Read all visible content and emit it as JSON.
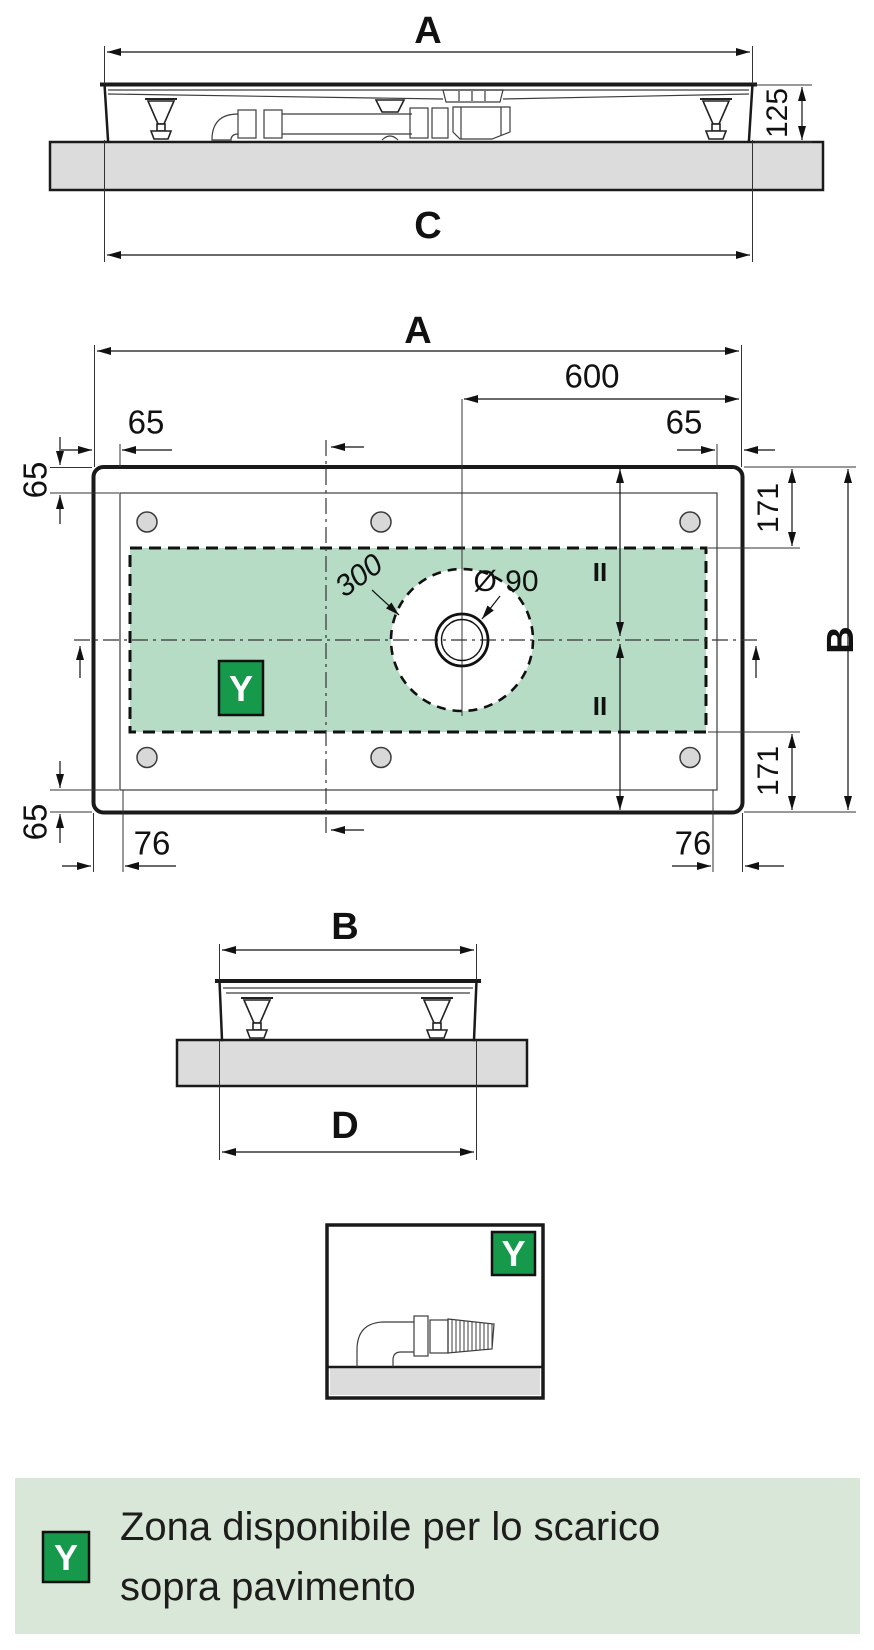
{
  "document": {
    "type": "technical-dimension-drawing",
    "subject": "shower tray installation drawing with drain zone"
  },
  "dims": {
    "A": "A",
    "B": "B",
    "C": "C",
    "D": "D",
    "h125": "125",
    "d600": "600",
    "d65": "65",
    "d171": "171",
    "d76": "76",
    "r300": "300",
    "dia90": "Ø 90",
    "equal": "II"
  },
  "badge": {
    "letter": "Y"
  },
  "legend": {
    "badge": "Y",
    "line1": "Zona disponibile per lo scarico",
    "line2": "sopra pavimento"
  },
  "colors": {
    "zone_fill": "#b7dcc6",
    "badge_green": "#16994a",
    "legend_bg": "#d9e7d9",
    "slab_gray": "#dcdcdc",
    "line": "#1a1a1a"
  }
}
